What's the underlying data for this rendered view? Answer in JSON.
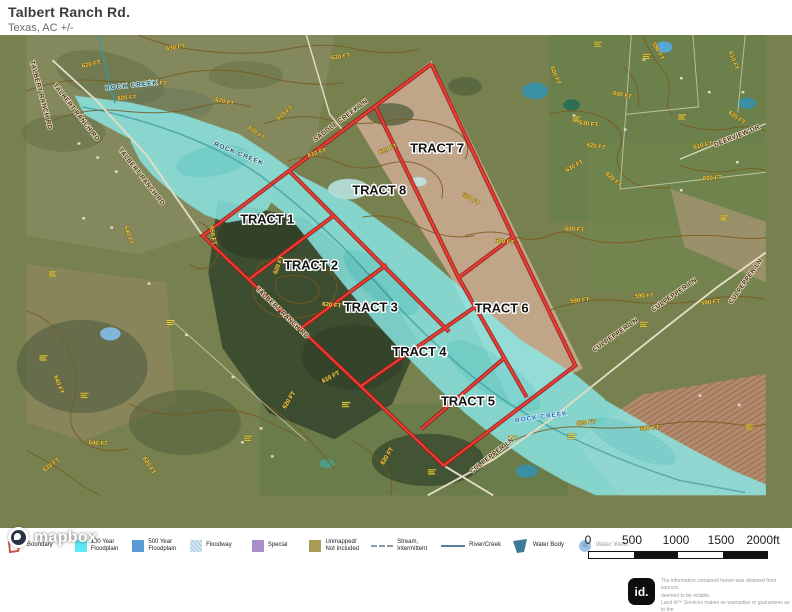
{
  "header": {
    "title": "Talbert Ranch Rd.",
    "subtitle": "Texas,  AC +/-"
  },
  "map": {
    "attribution": "mapbox",
    "colors": {
      "boundary_red": "#ef3b30",
      "floodplain_cyan": "#8ae8e8",
      "contour_brown": "#7a5a1f",
      "contour_label_yellow": "#f2d24b"
    },
    "tracts": [
      {
        "label": "TRACT 1",
        "x": 258,
        "y": 237
      },
      {
        "label": "TRACT 2",
        "x": 305,
        "y": 286
      },
      {
        "label": "TRACT 3",
        "x": 369,
        "y": 331
      },
      {
        "label": "TRACT 4",
        "x": 421,
        "y": 379
      },
      {
        "label": "TRACT 5",
        "x": 473,
        "y": 432
      },
      {
        "label": "TRACT 6",
        "x": 509,
        "y": 332
      },
      {
        "label": "TRACT 7",
        "x": 440,
        "y": 161
      },
      {
        "label": "TRACT 8",
        "x": 378,
        "y": 206
      }
    ],
    "road_labels": [
      {
        "text": "TALBERT RANCH RD",
        "x": 52,
        "y": 119,
        "rot": 52
      },
      {
        "text": "TALBERT RANCH RD",
        "x": 122,
        "y": 188,
        "rot": 52
      },
      {
        "text": "TALBERT RANCH RD",
        "x": 273,
        "y": 334,
        "rot": 44
      },
      {
        "text": "TALBERT RANCH RD",
        "x": 14,
        "y": 100,
        "rot": 75
      },
      {
        "text": "SADDLE CREEK LN",
        "x": 338,
        "y": 128,
        "rot": -37
      },
      {
        "text": "CULPEPPER LN",
        "x": 632,
        "y": 358,
        "rot": -35
      },
      {
        "text": "CULPEPPER LN",
        "x": 695,
        "y": 315,
        "rot": -35
      },
      {
        "text": "CULPEPPER LN",
        "x": 500,
        "y": 487,
        "rot": -38
      },
      {
        "text": "CULPEPPER LN",
        "x": 772,
        "y": 300,
        "rot": -55
      },
      {
        "text": "DEERVIEW DR",
        "x": 762,
        "y": 145,
        "rot": -22
      }
    ],
    "water_labels": [
      {
        "text": "ROCK CREEK",
        "x": 113,
        "y": 91,
        "rot": -6,
        "cls": ""
      },
      {
        "text": "ROCK CREEK",
        "x": 227,
        "y": 164,
        "rot": 22,
        "cls": ""
      },
      {
        "text": "ROCK CREEK",
        "x": 552,
        "y": 446,
        "rot": -8,
        "cls": "blue"
      }
    ],
    "contour_labels": [
      {
        "text": "620 FT",
        "x": 70,
        "y": 68,
        "rot": -12
      },
      {
        "text": "630 FT",
        "x": 160,
        "y": 50,
        "rot": -8
      },
      {
        "text": "620 FT",
        "x": 140,
        "y": 88,
        "rot": 8
      },
      {
        "text": "620 FT",
        "x": 108,
        "y": 104,
        "rot": -4
      },
      {
        "text": "620 FT",
        "x": 212,
        "y": 108,
        "rot": 14
      },
      {
        "text": "630 FT",
        "x": 245,
        "y": 141,
        "rot": 38
      },
      {
        "text": "610 FT",
        "x": 278,
        "y": 120,
        "rot": -40
      },
      {
        "text": "610 FT",
        "x": 312,
        "y": 163,
        "rot": -18
      },
      {
        "text": "630 FT",
        "x": 337,
        "y": 60,
        "rot": -8
      },
      {
        "text": "610 FT",
        "x": 388,
        "y": 159,
        "rot": -22
      },
      {
        "text": "600 FT",
        "x": 512,
        "y": 258,
        "rot": 6
      },
      {
        "text": "600 FT",
        "x": 587,
        "y": 245,
        "rot": 4
      },
      {
        "text": "600 FT",
        "x": 475,
        "y": 212,
        "rot": 30
      },
      {
        "text": "590 FT",
        "x": 675,
        "y": 53,
        "rot": 62
      },
      {
        "text": "600 FT",
        "x": 565,
        "y": 79,
        "rot": 68
      },
      {
        "text": "600 FT",
        "x": 638,
        "y": 101,
        "rot": 12
      },
      {
        "text": "630 FT",
        "x": 602,
        "y": 132,
        "rot": 8
      },
      {
        "text": "620 FT",
        "x": 610,
        "y": 156,
        "rot": 10
      },
      {
        "text": "620 FT",
        "x": 628,
        "y": 191,
        "rot": 40
      },
      {
        "text": "630 FT",
        "x": 588,
        "y": 177,
        "rot": -28
      },
      {
        "text": "610 FT",
        "x": 756,
        "y": 63,
        "rot": 70
      },
      {
        "text": "620 FT",
        "x": 760,
        "y": 125,
        "rot": 36
      },
      {
        "text": "610 FT",
        "x": 725,
        "y": 155,
        "rot": -12
      },
      {
        "text": "600 FT",
        "x": 735,
        "y": 190,
        "rot": -4
      },
      {
        "text": "590 FT",
        "x": 593,
        "y": 321,
        "rot": -6
      },
      {
        "text": "590 FT",
        "x": 662,
        "y": 316,
        "rot": -4
      },
      {
        "text": "590 FT",
        "x": 733,
        "y": 323,
        "rot": -4
      },
      {
        "text": "580 FT",
        "x": 600,
        "y": 452,
        "rot": -6
      },
      {
        "text": "580 FT",
        "x": 668,
        "y": 458,
        "rot": -4
      },
      {
        "text": "640 FT",
        "x": 108,
        "y": 250,
        "rot": 72
      },
      {
        "text": "640 FT",
        "x": 33,
        "y": 410,
        "rot": 70
      },
      {
        "text": "640 FT",
        "x": 77,
        "y": 474,
        "rot": 4
      },
      {
        "text": "630 FT",
        "x": 28,
        "y": 497,
        "rot": -36
      },
      {
        "text": "620 FT",
        "x": 130,
        "y": 497,
        "rot": 58
      },
      {
        "text": "650 FT",
        "x": 198,
        "y": 250,
        "rot": 80
      },
      {
        "text": "620 FT",
        "x": 272,
        "y": 282,
        "rot": -68
      },
      {
        "text": "620 FT",
        "x": 327,
        "y": 326,
        "rot": 6
      },
      {
        "text": "610 FT",
        "x": 327,
        "y": 403,
        "rot": -28
      },
      {
        "text": "620 FT",
        "x": 283,
        "y": 427,
        "rot": -58
      },
      {
        "text": "620 FT",
        "x": 388,
        "y": 487,
        "rot": -58
      }
    ],
    "parcel_markers": [
      [
        58,
        418
      ],
      [
        24,
        288
      ],
      [
        14,
        378
      ],
      [
        150,
        340
      ],
      [
        233,
        464
      ],
      [
        338,
        428
      ],
      [
        430,
        500
      ],
      [
        516,
        464
      ],
      [
        608,
        42
      ],
      [
        660,
        55
      ],
      [
        698,
        120
      ],
      [
        743,
        228
      ],
      [
        770,
        452
      ],
      [
        657,
        342
      ],
      [
        585,
        122
      ],
      [
        580,
        462
      ]
    ],
    "houses": [
      [
        55,
        150
      ],
      [
        75,
        165
      ],
      [
        95,
        180
      ],
      [
        60,
        230
      ],
      [
        90,
        240
      ],
      [
        130,
        300
      ],
      [
        170,
        355
      ],
      [
        220,
        400
      ],
      [
        250,
        455
      ],
      [
        230,
        470
      ],
      [
        262,
        485
      ],
      [
        660,
        60
      ],
      [
        700,
        80
      ],
      [
        730,
        95
      ],
      [
        760,
        170
      ],
      [
        700,
        200
      ],
      [
        745,
        230
      ],
      [
        720,
        420
      ],
      [
        762,
        430
      ],
      [
        585,
        120
      ],
      [
        640,
        135
      ],
      [
        766,
        95
      ]
    ],
    "scalebar": {
      "ticks": [
        "0",
        "500",
        "1000",
        "1500",
        "2000ft"
      ]
    }
  },
  "legend": {
    "items": [
      {
        "name": "boundary",
        "label": "Boundary"
      },
      {
        "name": "floodplain-100-year",
        "label": "100 Year\nFloodplain",
        "color": "#5ce9f2"
      },
      {
        "name": "floodplain-500-year",
        "label": "500 Year\nFloodplain",
        "color": "#5b9bd5"
      },
      {
        "name": "floodway",
        "label": "Floodway",
        "color": "#d4e8f2"
      },
      {
        "name": "special",
        "label": "Special",
        "color": "#a98fc9"
      },
      {
        "name": "unmapped",
        "label": "Unmapped/\nNot Included",
        "color": "#a99c55"
      },
      {
        "name": "stream-intermittent",
        "label": "Stream,\nIntermittent"
      },
      {
        "name": "river-creek",
        "label": "River/Creek"
      },
      {
        "name": "water-body",
        "label": "Water Body",
        "color": "#3b7a99"
      },
      {
        "name": "water-wells",
        "label": "Water Wells",
        "color": "#1f78d1"
      }
    ]
  },
  "footer": {
    "logo": "id.",
    "disclaimer_lines": [
      "The information contained herein was obtained from sources",
      "deemed to be reliable.",
      " Land id™ Services makes no warranties or guarantees as to the",
      "completeness or accuracy thereof."
    ]
  }
}
